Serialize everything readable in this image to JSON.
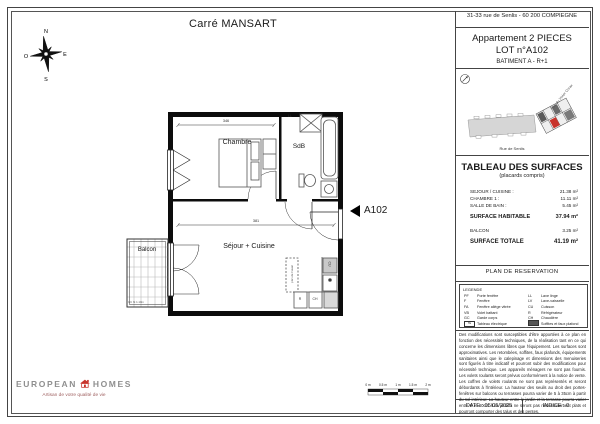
{
  "sheet": {
    "title": "Carré MANSART"
  },
  "compass": {
    "n": "N",
    "e": "E",
    "s": "S",
    "o": "O"
  },
  "plan": {
    "rooms": {
      "chambre": "Chambre",
      "sdb": "SdB",
      "sejour": "Séjour + Cuisine",
      "balcon": "Balcon"
    },
    "marker": "A102",
    "labels": {
      "ll": "LL",
      "cu": "CU",
      "r": "R",
      "ch": "CH",
      "kitchen_note": "plan de travail",
      "balcon_note": "GC ht 1.10m"
    },
    "dims": {
      "chambre_width": "346",
      "sejour_width": "381"
    }
  },
  "titleblock": {
    "address": "31-33 rue de Senlis - 60 200 COMPIEGNE",
    "apartment_line1": "Appartement 2 PIECES",
    "apartment_line2": "LOT n°A102",
    "building": "BATIMENT A - R+1",
    "siteplan": {
      "street_bottom": "Rue de Senlis",
      "street_right": "Rue du Vivier Corax"
    },
    "surfaces": {
      "title": "TABLEAU DES SURFACES",
      "subtitle": "(placards compris)",
      "rows": [
        {
          "label": "SEJOUR / CUISINE :",
          "value": "21.38 m²"
        },
        {
          "label": "CHAMBRE 1 :",
          "value": "11.11 m²"
        },
        {
          "label": "SALLE DE BAIN :",
          "value": "5.45 m²"
        }
      ],
      "habitable_label": "SURFACE HABITABLE",
      "habitable_value": "37.94 m²",
      "balcon_label": "BALCON",
      "balcon_value": "3.25 m²",
      "totale_label": "SURFACE TOTALE",
      "totale_value": "41.19 m²"
    },
    "reservation_title": "PLAN DE RESERVATION",
    "legend": {
      "title": "LEGENDE",
      "col1": [
        {
          "abbr": "PF",
          "label": "Porte fenêtre"
        },
        {
          "abbr": "F",
          "label": "Fenêtre"
        },
        {
          "abbr": "FA",
          "label": "Fenêtre allège vitrée"
        },
        {
          "abbr": "VB",
          "label": "Volet battant"
        },
        {
          "abbr": "GC",
          "label": "Garde corps"
        },
        {
          "abbr": "TE",
          "label": "Tableau électrique"
        }
      ],
      "col2": [
        {
          "abbr": "LL",
          "label": "Lave linge"
        },
        {
          "abbr": "LV",
          "label": "Lave-vaisselle"
        },
        {
          "abbr": "CU",
          "label": "Cuisson"
        },
        {
          "abbr": "R",
          "label": "Réfrigérateur"
        },
        {
          "abbr": "CH",
          "label": "Chaudière"
        },
        {
          "abbr": "",
          "label": "Soffites et faux plafond"
        }
      ]
    },
    "disclaimer": "Des modifications sont susceptibles d'être apportées à ce plan en fonction des nécessités techniques, de la réalisation tant en ce qui concerne les dimensions libres que l'équipement. Les surfaces sont approximatives. Les retombées, soffites, faux plafonds, équipements sanitaires ainsi que le calepinage et dimensions des menuiseries sont figurés à titre indicatif et pourront subir des modifications pour nécessité technique. Les appareils ménagers ne sont pas fournis. Les volets roulants seront prévus conformément à la notice de vente. Les coffres de volets roulants ne sont pas représentés et seront débordants à l'intérieur. La hauteur des seuils au droit des portes-fenêtres sur balcons ou terrasses pourra varier de 5 à 35cm à partir du sol intérieur. La hauteur entre le jardin et la terrasse pourra varier entre 0 et 60cm. Les jardins ne seront pas nécessairement plats et pourront comporter des talus et des pentes.",
    "date_label": "DATE : 05/05/2025",
    "indice_label": "INDICE : 0"
  },
  "branding": {
    "name_left": "EUROPEAN",
    "name_right": "HOMES",
    "tagline": "Artisan de votre qualité de vie"
  },
  "scalebar": {
    "labels": [
      "0 m",
      "0.5 m",
      "1 m",
      "1.5 m",
      "2 m"
    ]
  },
  "colors": {
    "accent_red": "#c8342c",
    "building_gray": "#d6d6d6"
  }
}
